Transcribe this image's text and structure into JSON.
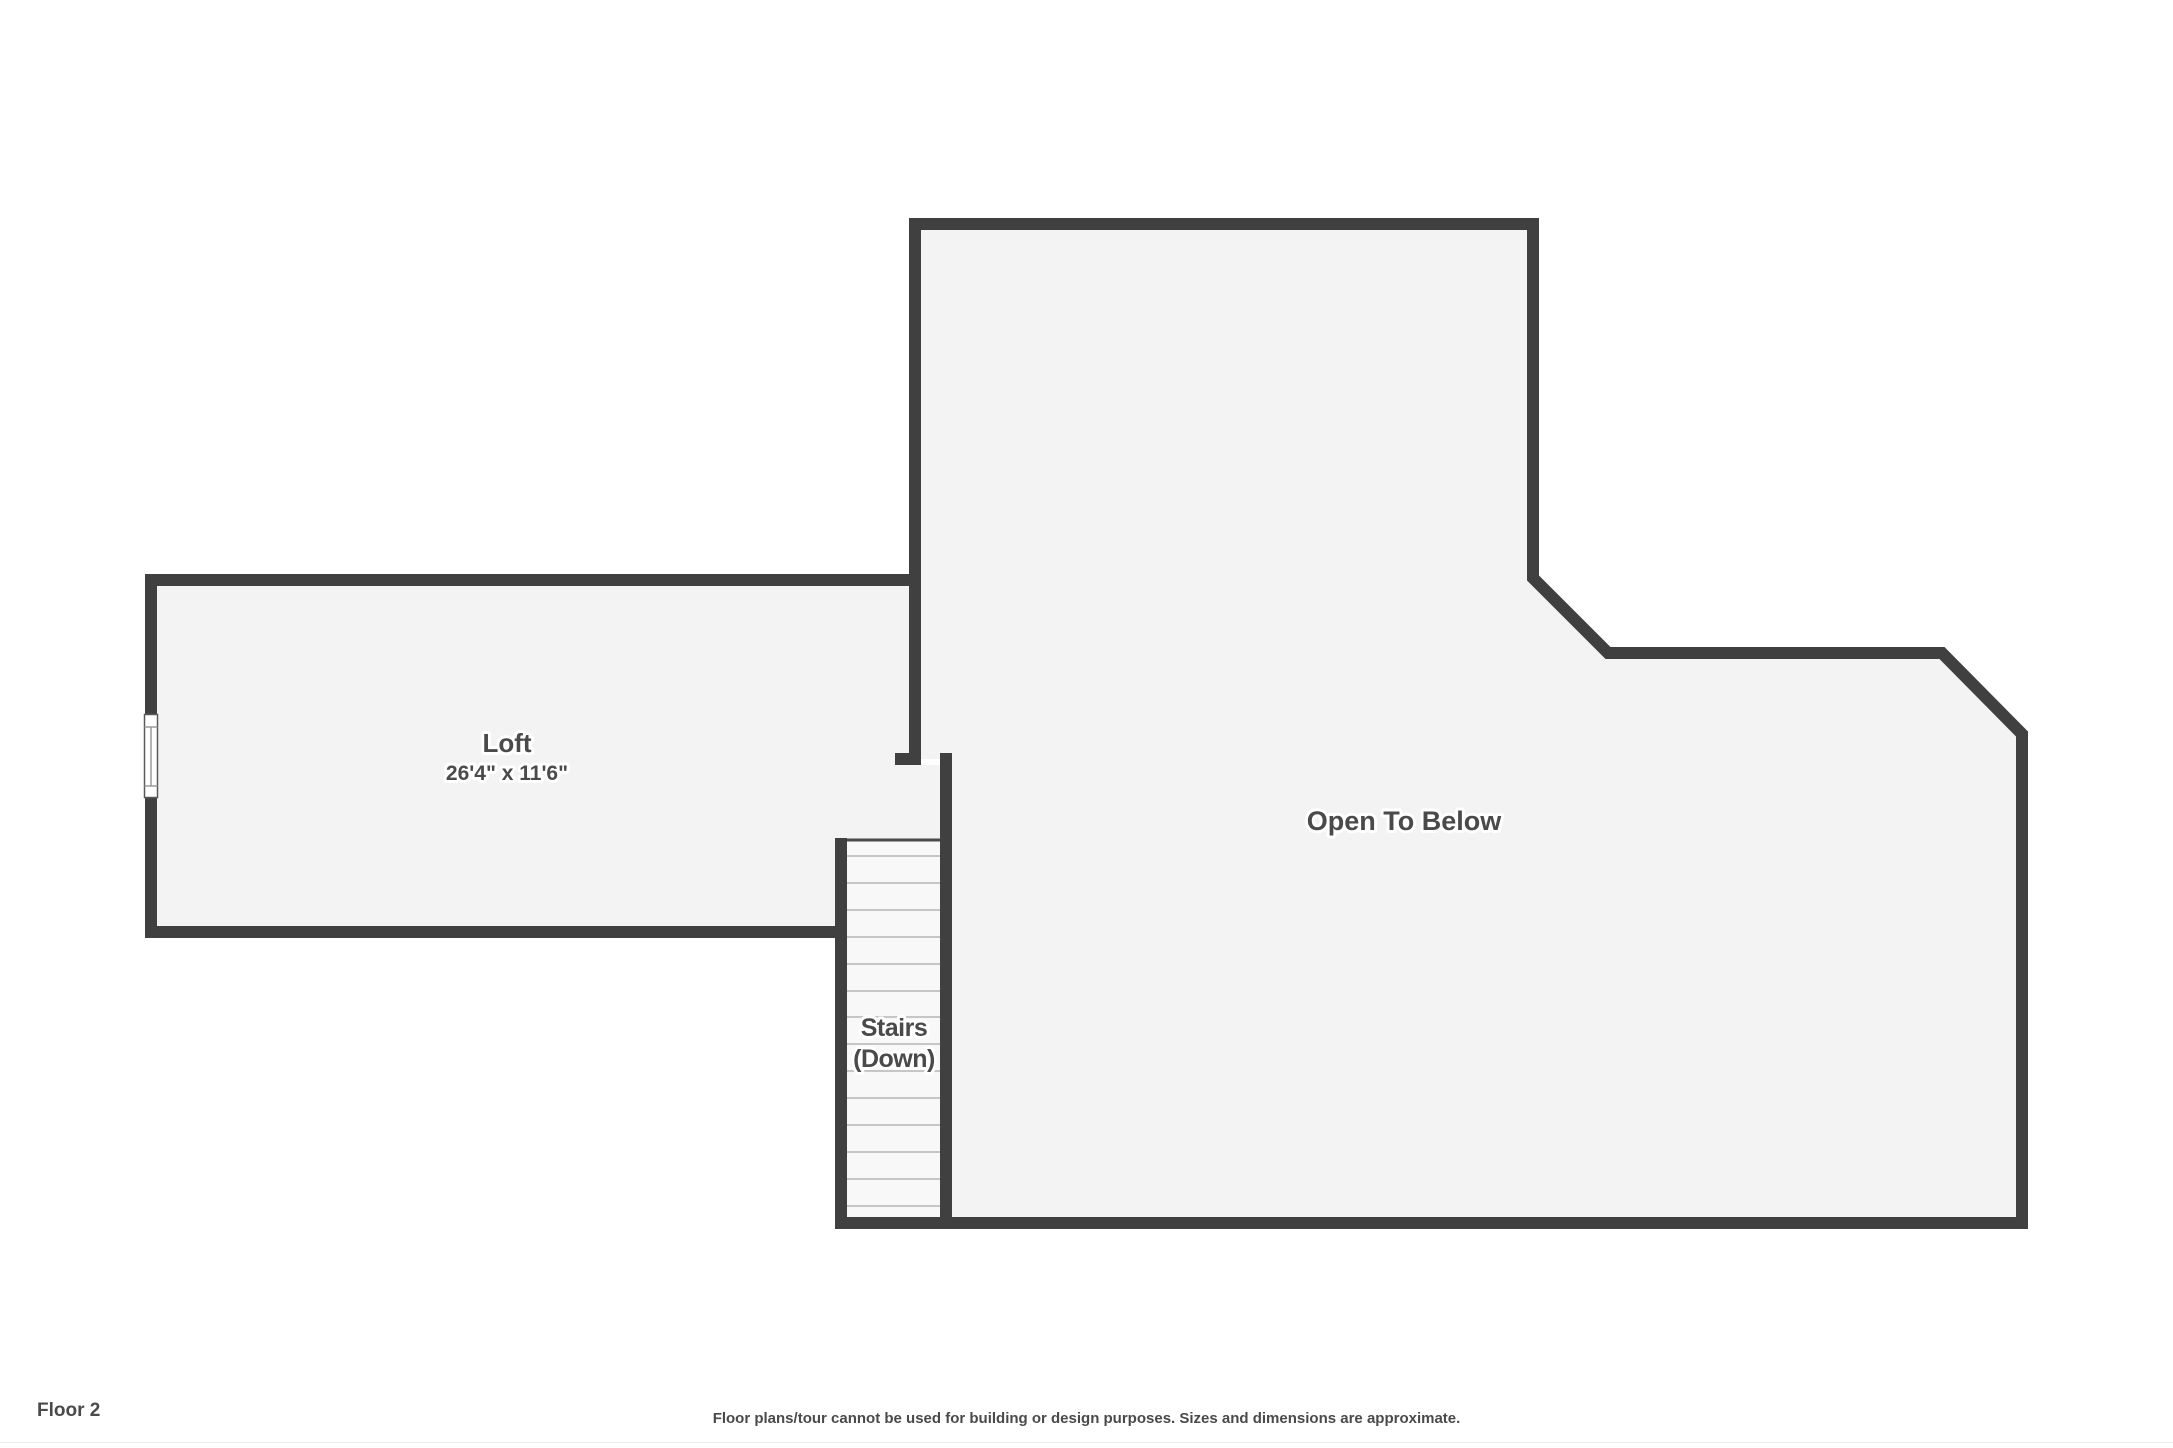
{
  "floor_plan": {
    "rooms": {
      "loft": {
        "name": "Loft",
        "dimensions": "26'4\" x 11'6\""
      },
      "open_to_below": {
        "name": "Open To Below"
      },
      "stairs": {
        "line1": "Stairs",
        "line2": "(Down)"
      }
    },
    "footer": {
      "floor_label": "Floor 2",
      "disclaimer": "Floor plans/tour cannot be used for building or design purposes. Sizes and dimensions are approximate."
    },
    "colors": {
      "wall": "#404040",
      "room_fill": "#f3f3f3",
      "stairs_fill": "#f8f8f8",
      "tread_line": "#c6c6c6",
      "stair_edge": "#4a4a4a",
      "label_text": "#4a4a4a",
      "background": "#ffffff"
    }
  }
}
